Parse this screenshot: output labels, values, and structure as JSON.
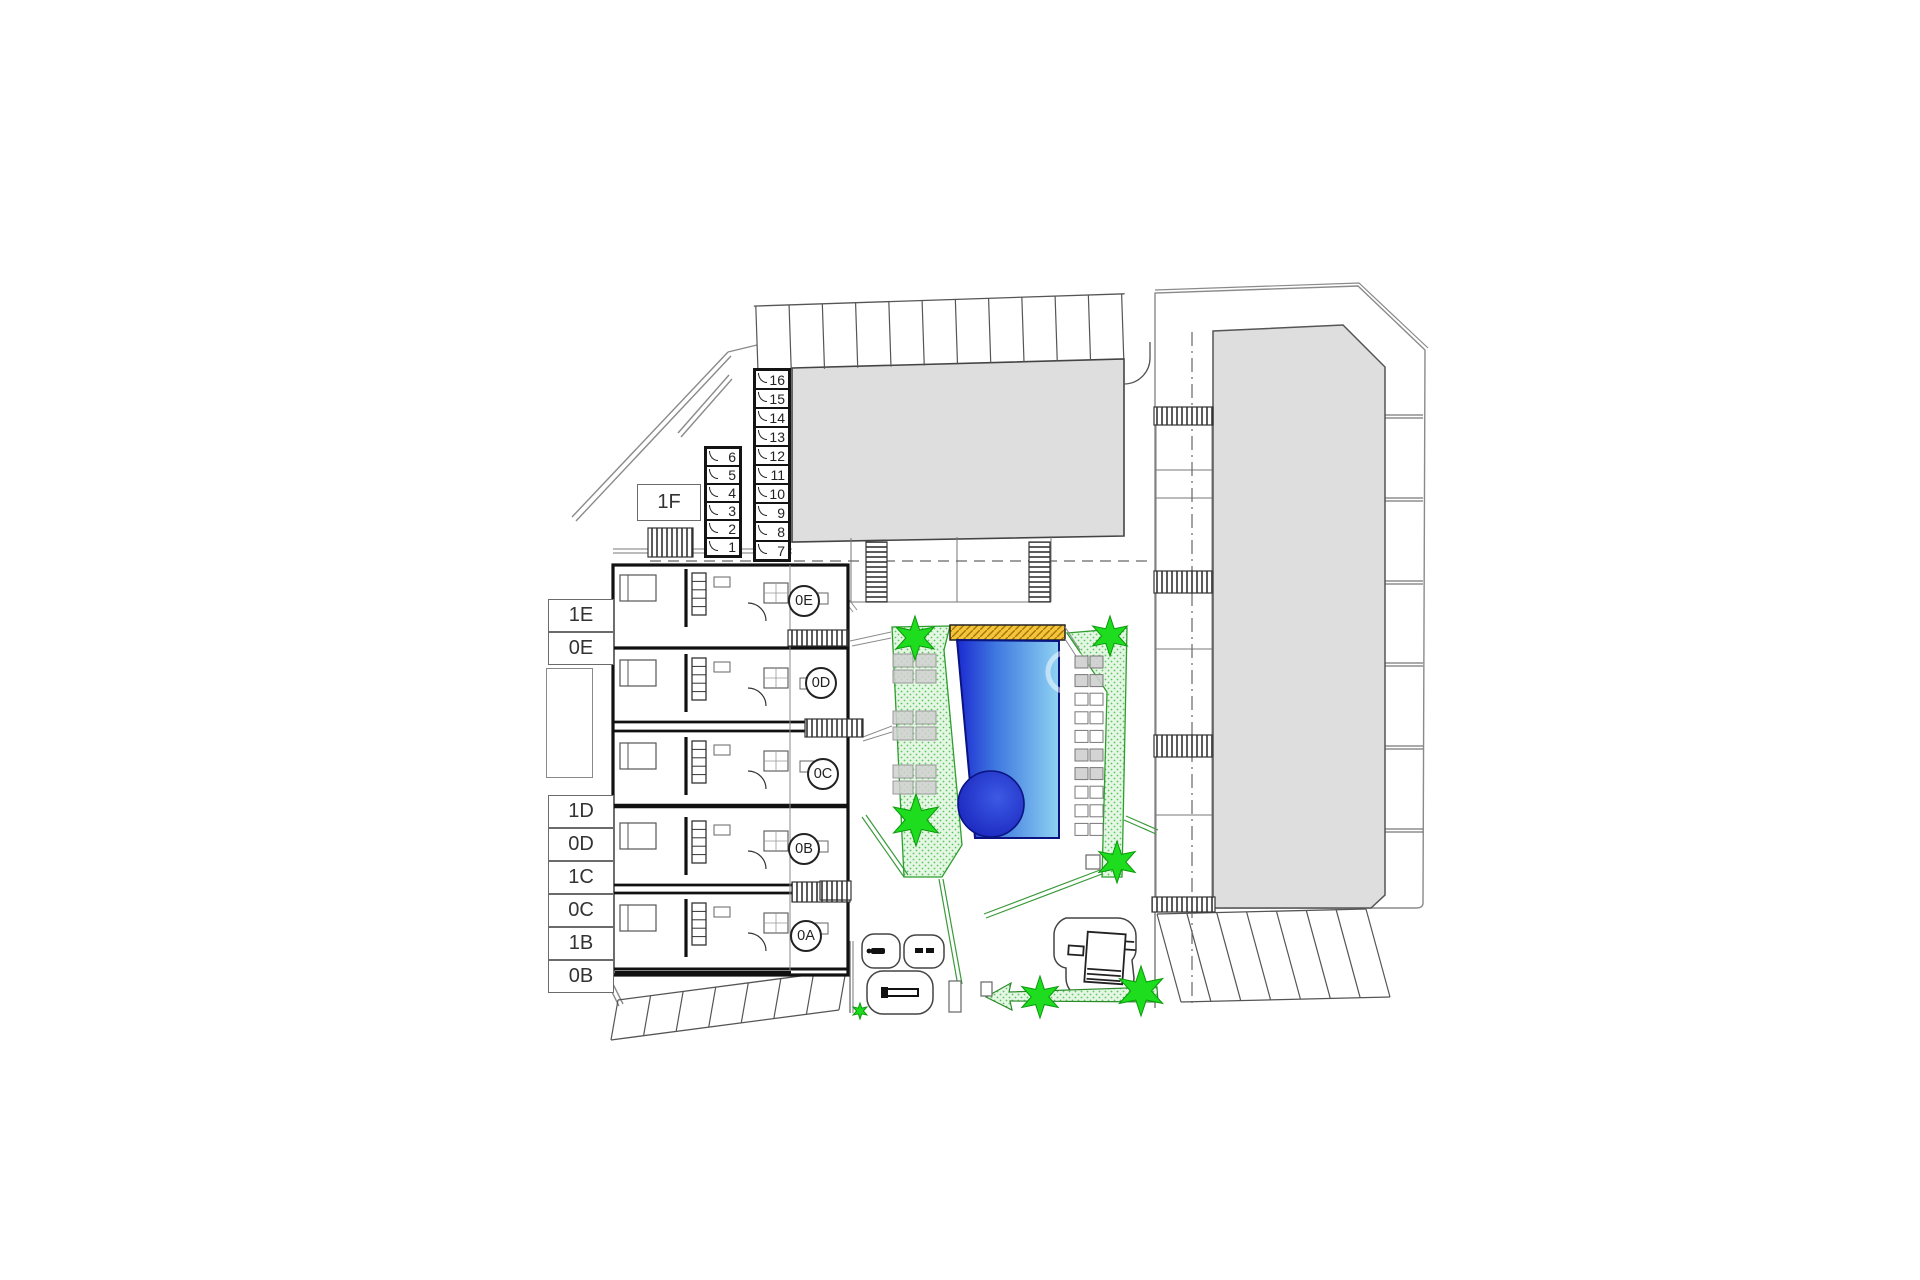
{
  "title": "Residential complex site / ground floor plan",
  "floor_plan": {
    "apartment_row_labels": {
      "upper": [
        "1E",
        "0E"
      ],
      "lower": [
        "1D",
        "0D",
        "1C",
        "0C",
        "1B",
        "0B"
      ],
      "penthouse": "1F"
    },
    "storage_numbers": {
      "left_column": [
        "6",
        "5",
        "4",
        "3",
        "2",
        "1"
      ],
      "right_column": [
        "16",
        "15",
        "14",
        "13",
        "12",
        "11",
        "10",
        "9",
        "8",
        "7"
      ]
    },
    "ground_unit_circles": [
      "0E",
      "0D",
      "0C",
      "0B",
      "0A"
    ],
    "site_features": {
      "trees_count": 7,
      "sun_lounger_left_groups": 3,
      "poolside_lounger_rows": 10,
      "parking_stalls": {
        "north_row": 11,
        "southeast_row": 7,
        "southwest_row": 7
      }
    },
    "colors": {
      "building_fill": "#dedede",
      "pool_dark": "#1b2ad0",
      "pool_mid": "#3f78e0",
      "pool_light": "#8ed2f2",
      "green_area": "#e4f6e4",
      "green_border": "#2e9e2e",
      "tree_green": "#1edc1e",
      "sun_deck_yellow": "#f2c53d"
    }
  }
}
